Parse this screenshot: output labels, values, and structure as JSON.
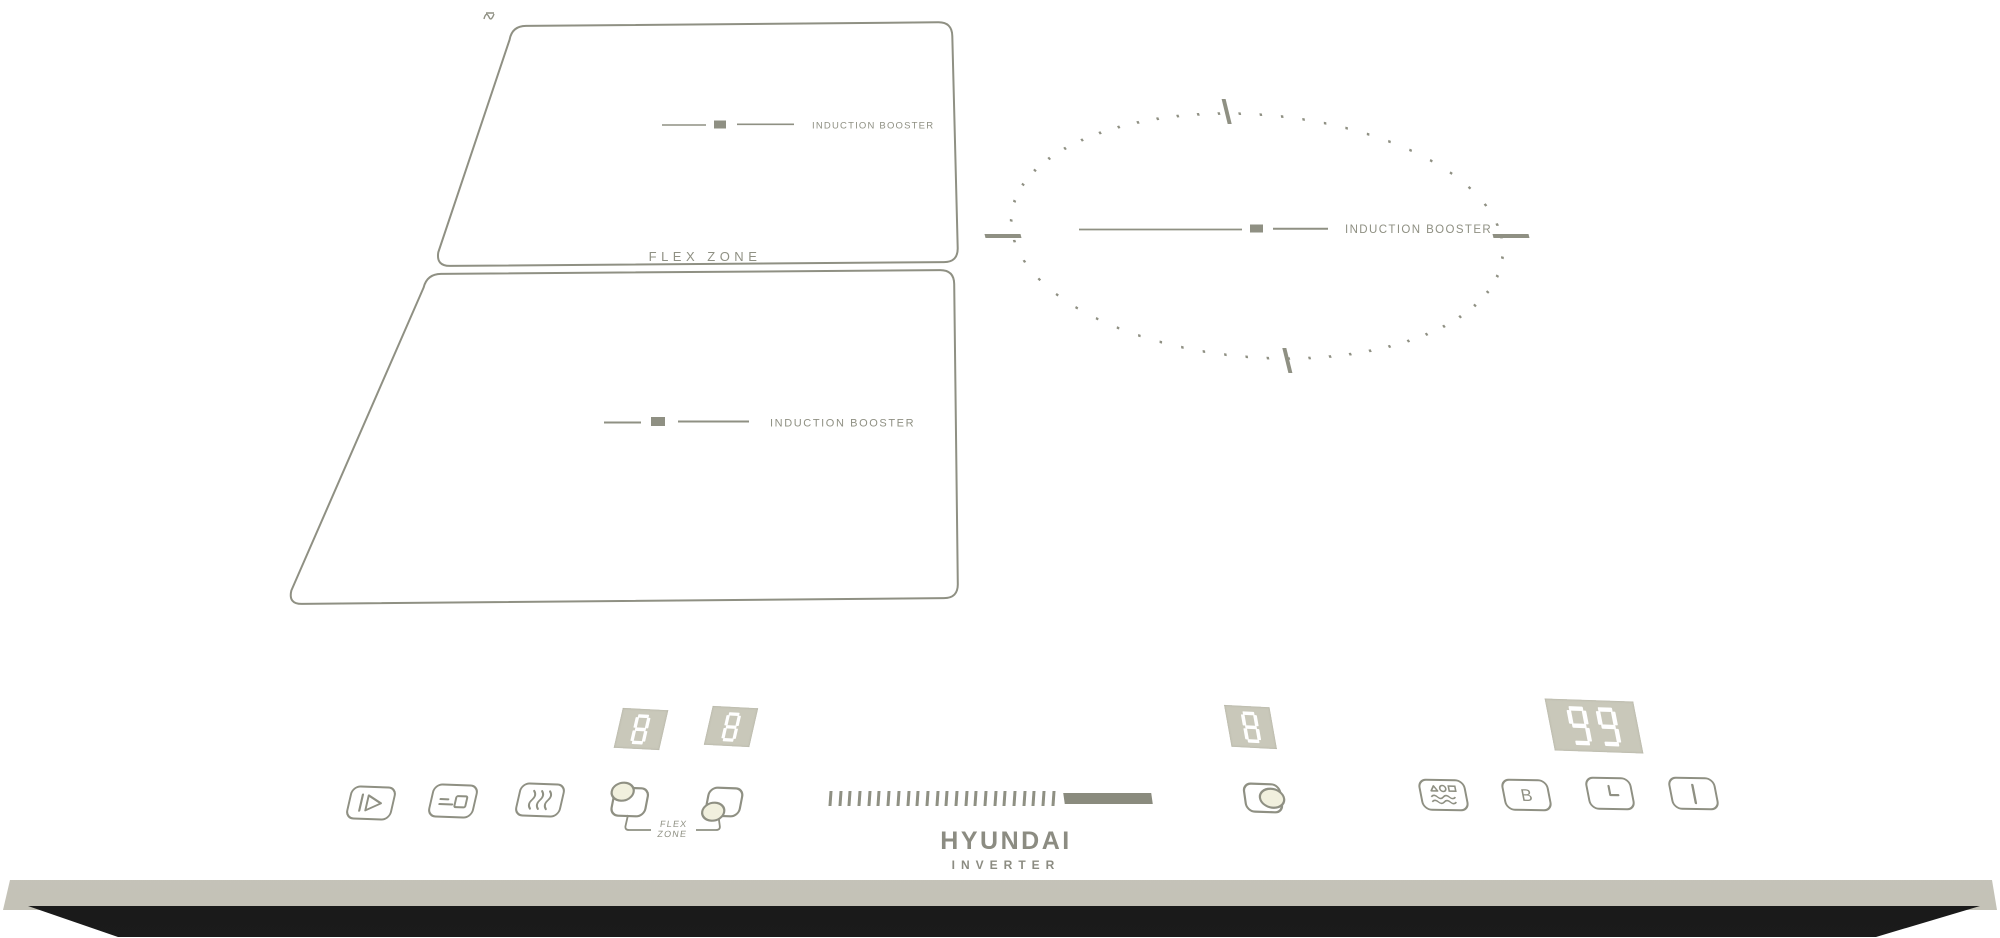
{
  "product": {
    "brand": "HYUNDAI",
    "series": "INVERTER"
  },
  "etched_labels": {
    "flex_zone": "FLEX ZONE",
    "induction_booster": "INDUCTION BOOSTER",
    "flex_button_line1": "FLEX",
    "flex_button_line2": "ZONE"
  },
  "displays": {
    "flex_upper_level": "8",
    "flex_lower_level": "8",
    "right_zone_level": "8",
    "timer": "99"
  },
  "controls": {
    "boost_label": "B",
    "slider_ticks": 24,
    "buttons": [
      {
        "name": "pause-stop-go",
        "icon": "pause-play-icon"
      },
      {
        "name": "child-lock",
        "icon": "key-lock-icon"
      },
      {
        "name": "keep-warm",
        "icon": "heat-waves-icon"
      },
      {
        "name": "flex-zone-upper-select",
        "icon": "zone-upper-icon"
      },
      {
        "name": "flex-zone-lower-select",
        "icon": "zone-lower-icon"
      },
      {
        "name": "right-zone-select",
        "icon": "zone-right-icon"
      },
      {
        "name": "auto-programs",
        "icon": "cookware-waves-icon"
      },
      {
        "name": "booster",
        "icon": "letter-B"
      },
      {
        "name": "timer",
        "icon": "clock-hands-icon"
      },
      {
        "name": "power",
        "icon": "power-bar-icon"
      }
    ]
  },
  "colors": {
    "background": "#ffffff",
    "glass": "#f1f0de",
    "etch": "#8f9083",
    "display_bg": "#c9c8ba",
    "digit": "#ffffff",
    "bevel": "#d6d4ca",
    "base": "#141414",
    "led": "#ffffff"
  }
}
